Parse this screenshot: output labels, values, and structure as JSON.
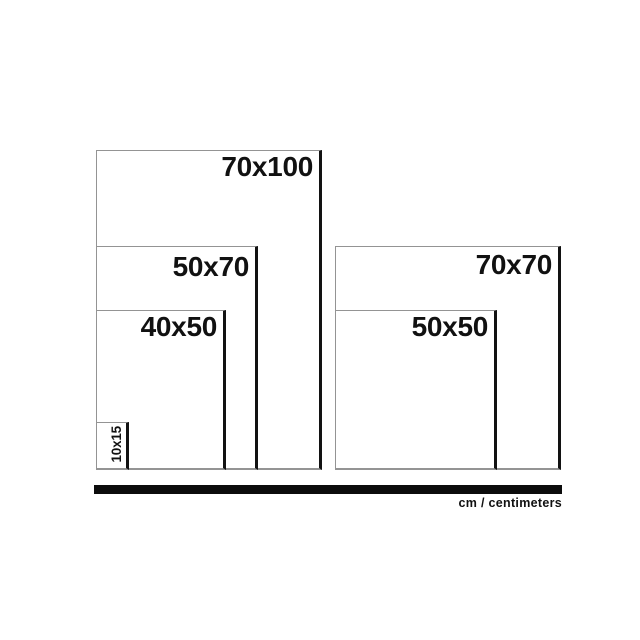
{
  "diagram": {
    "description": "Nested rectangles comparing common print / frame sizes in centimeters",
    "rects": [
      {
        "label": "70x100",
        "width_cm": 70,
        "height_cm": 100,
        "group": "left"
      },
      {
        "label": "50x70",
        "width_cm": 50,
        "height_cm": 70,
        "group": "left"
      },
      {
        "label": "40x50",
        "width_cm": 40,
        "height_cm": 50,
        "group": "left"
      },
      {
        "label": "10x15",
        "width_cm": 10,
        "height_cm": 15,
        "group": "left"
      },
      {
        "label": "70x70",
        "width_cm": 70,
        "height_cm": 70,
        "group": "right"
      },
      {
        "label": "50x50",
        "width_cm": 50,
        "height_cm": 50,
        "group": "right"
      }
    ],
    "footer": {
      "unit_label": "cm / centimeters"
    }
  },
  "colors": {
    "background": "#ffffff",
    "outline": "#949494",
    "edge": "#121212",
    "bar": "#0c0c0c",
    "text": "#111111"
  }
}
